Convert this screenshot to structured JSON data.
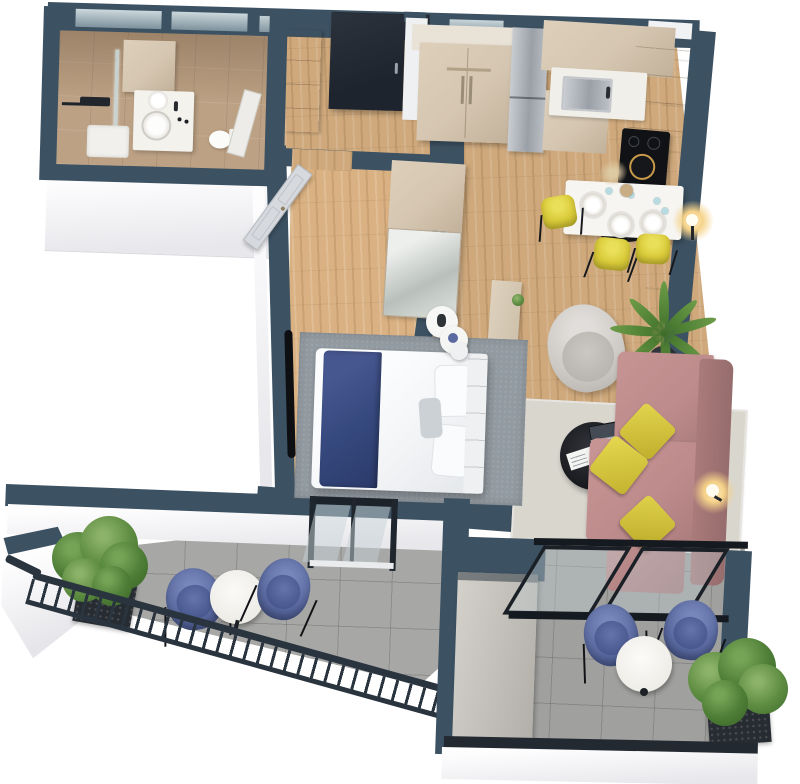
{
  "scene": {
    "kind": "3d-floor-plan-render",
    "view": "top-down-perspective",
    "background": "#ffffff",
    "apartment": "one-bedroom apartment with two balconies"
  },
  "palette": {
    "wall": "#3c5162",
    "entryDoor": "#272e38",
    "exteriorWall": "#f4f4f6",
    "woodFloor": "#cfa97c",
    "bathroomTile": "#bca184",
    "balconyTile": "#a7a7a5",
    "cabinet": "#d5c6b1",
    "counter": "#f1efe9",
    "steel": "#aeb2b8",
    "sofa": "#bd8b8b",
    "sofaDark": "#aa7b7b",
    "accentYellow": "#d9ca39",
    "chairBlue": "#5a6aa1",
    "bedNavy": "#36497e",
    "duvet": "#f3f4f6",
    "rugLiving": "#d9d6ce",
    "rugBedroom": "#939ba2",
    "plantGreen": "#4d7d36",
    "plantDark": "#3a6527",
    "planter": "#272c32",
    "railing": "#2a343f",
    "glassTint": "#c6d2d6",
    "lampGlow": "#f6d38a"
  },
  "rooms": {
    "bathroom": {
      "floor": "beige tile",
      "items": [
        "shower-head",
        "glass-shower-screen",
        "shower-tray",
        "tall-cabinet",
        "vanity-with-round-sink",
        "toilet",
        "bathroom-door"
      ]
    },
    "hallway": {
      "floor": "wood",
      "items": [
        "entrance-door",
        "shoe-cabinet",
        "double-door-wardrobe"
      ]
    },
    "kitchen": {
      "floor": "wood",
      "items": [
        "fridge",
        "upper-and-lower-cabinets",
        "white-countertop",
        "steel-sink",
        "black-cooktop",
        "pan-on-cooktop"
      ]
    },
    "dining": {
      "items": [
        "white-dining-table",
        "3-plates",
        "4-wine-glasses",
        "vase-with-pampas",
        "3-yellow-chairs",
        "glowing-floor-lamp"
      ]
    },
    "living": {
      "floor": "wood",
      "items": [
        "gray-armchair",
        "potted-palm",
        "light-area-rug",
        "black-round-coffee-table",
        "laptop",
        "magazine",
        "pink-corner-sofa",
        "3-yellow-cushions",
        "glowing-floor-lamp",
        "beige-sideboard"
      ]
    },
    "bedroom": {
      "floor": "wood",
      "items": [
        "double-bed-white-duvet",
        "navy-throw",
        "pillows",
        "headboard",
        "2-round-nightstands",
        "stool",
        "wardrobe-with-mirror",
        "wall-tv",
        "gray-rug",
        "open-white-door",
        "balcony-door"
      ]
    },
    "balcony_left": {
      "floor": "gray tile",
      "items": [
        "metal-railing",
        "white-parapet",
        "planter-shrub",
        "round-bistro-table",
        "2-blue-chairs"
      ]
    },
    "balcony_right": {
      "floor": "gray tile",
      "items": [
        "glass-sliding-door",
        "storage-panel",
        "round-bistro-table",
        "2-blue-chairs",
        "planter-shrub",
        "white-parapet"
      ]
    }
  },
  "counts": {
    "yellow_dining_chairs": 3,
    "yellow_cushions": 3,
    "blue_balcony_chairs": 4,
    "balconies": 2,
    "plants": 4
  }
}
